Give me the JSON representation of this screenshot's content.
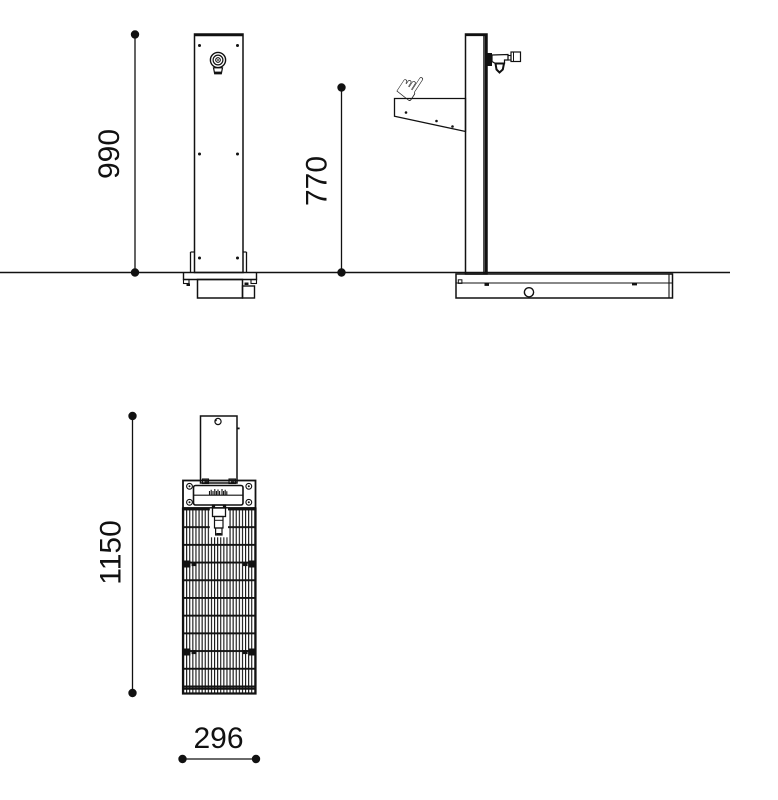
{
  "diagram": {
    "type": "technical-dimension-drawing",
    "views": {
      "front": "front elevation of fountain post",
      "side": "side elevation with push tap and bracket",
      "plan": "plan view with drainage grating"
    },
    "dimensions": {
      "front_height": "990",
      "tap_height": "770",
      "plan_length": "1150",
      "plan_width": "296"
    },
    "icons": {
      "pointing_hand": "☝"
    },
    "colors": {
      "line": "#111111",
      "background": "#ffffff"
    }
  }
}
